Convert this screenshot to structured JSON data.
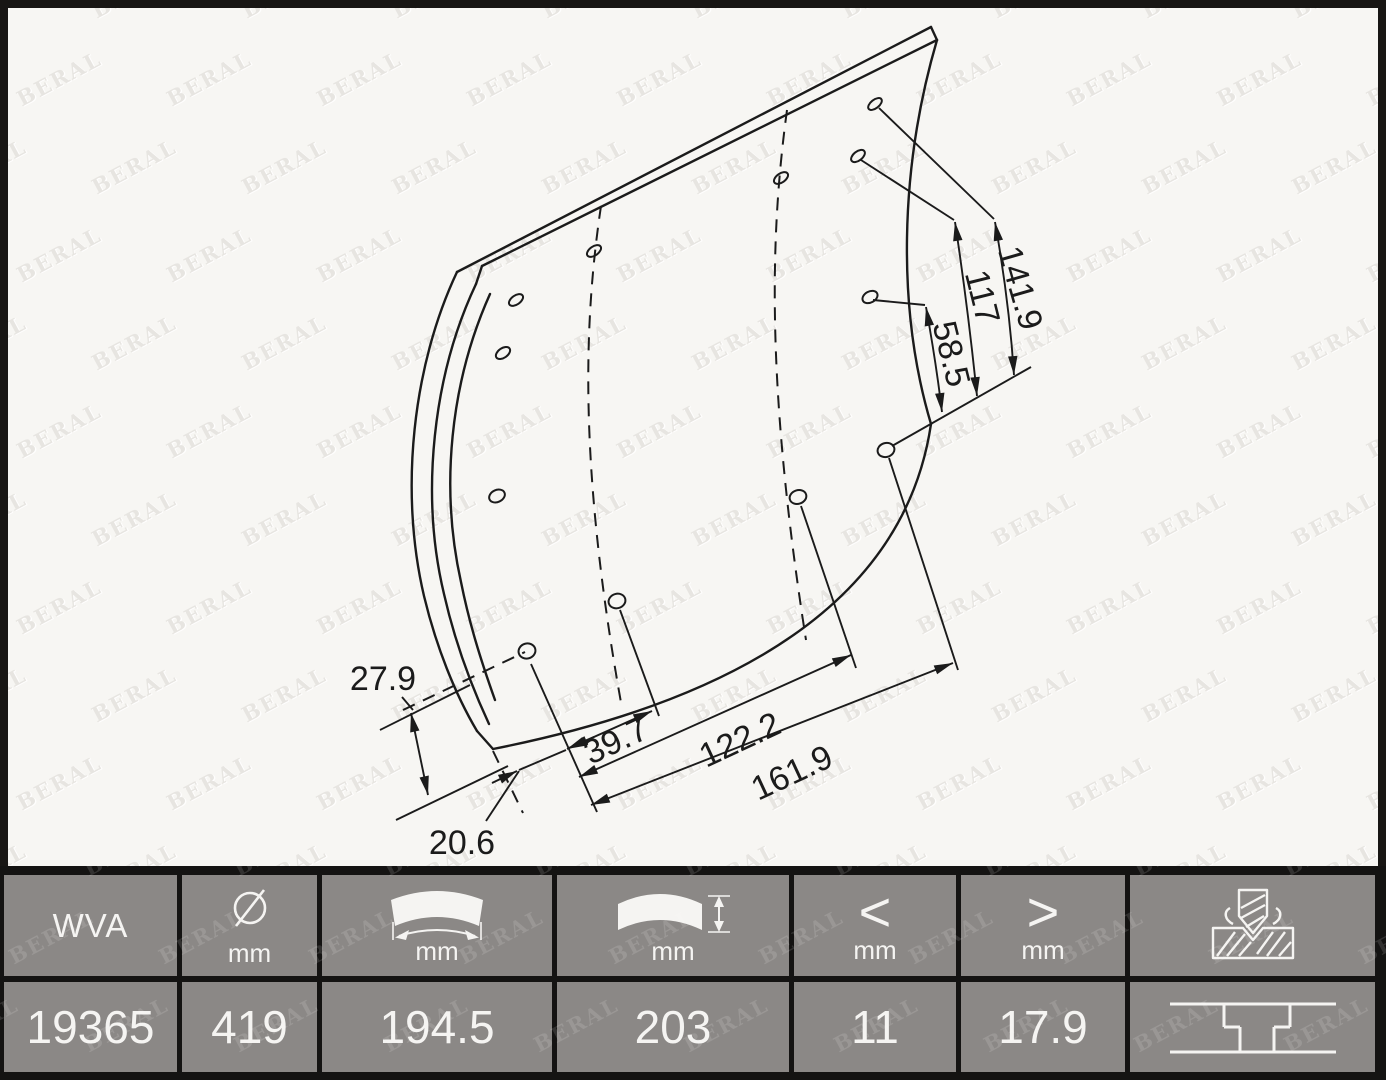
{
  "brand_watermark": {
    "text": "BERAL"
  },
  "drawing": {
    "description": "isometric technical drawing of curved drum-brake lining with rivet holes",
    "dimensions": {
      "v141_9": "141.9",
      "v117": "117",
      "v58_5": "58.5",
      "v27_9": "27.9",
      "v20_6": "20.6",
      "v39_7": "39.7",
      "v122_2": "122.2",
      "v161_9": "161.9"
    }
  },
  "table": {
    "wva": {
      "label": "WVA",
      "value": "19365"
    },
    "drum_diameter": {
      "unit": "mm",
      "value": "419"
    },
    "length": {
      "unit": "mm",
      "value": "194.5"
    },
    "width": {
      "unit": "mm",
      "value": "203"
    },
    "thickness_min": {
      "symbol": "<",
      "unit": "mm",
      "value": "11"
    },
    "thickness_max": {
      "symbol": ">",
      "unit": "mm",
      "value": "17.9"
    }
  }
}
